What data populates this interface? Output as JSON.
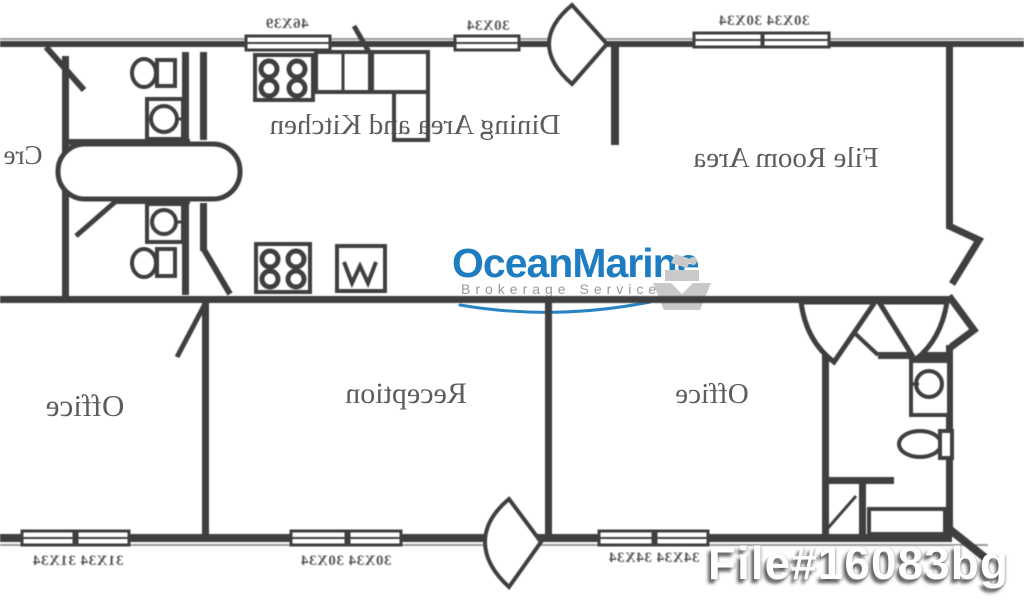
{
  "floorplan": {
    "mirrored": true,
    "ink_color": "#3f3f3f",
    "rooms": {
      "crew_partial": "Cre",
      "dining_kitchen": "Dining Area and Kitchen",
      "file_room": "File Room Area",
      "office_left": "Office",
      "reception": "Reception",
      "office_right": "Office"
    },
    "window_dimensions": {
      "top": [
        "46X39",
        "30X34",
        "30X34 30X34"
      ],
      "bottom": [
        "31X34 31X34",
        "30X34 30X34",
        "34X34 34X34"
      ]
    }
  },
  "watermark": {
    "brand": "OceanMarine",
    "tagline": "Brokerage Services",
    "brand_color": "#1e7dc1",
    "tagline_color": "#999999",
    "swoosh_color": "#2a84c4",
    "icon": "ship-icon",
    "icon_color": "#c9c9c9"
  },
  "overlay": {
    "file_number": "File#16083bg",
    "text_color": "#ffffff"
  }
}
